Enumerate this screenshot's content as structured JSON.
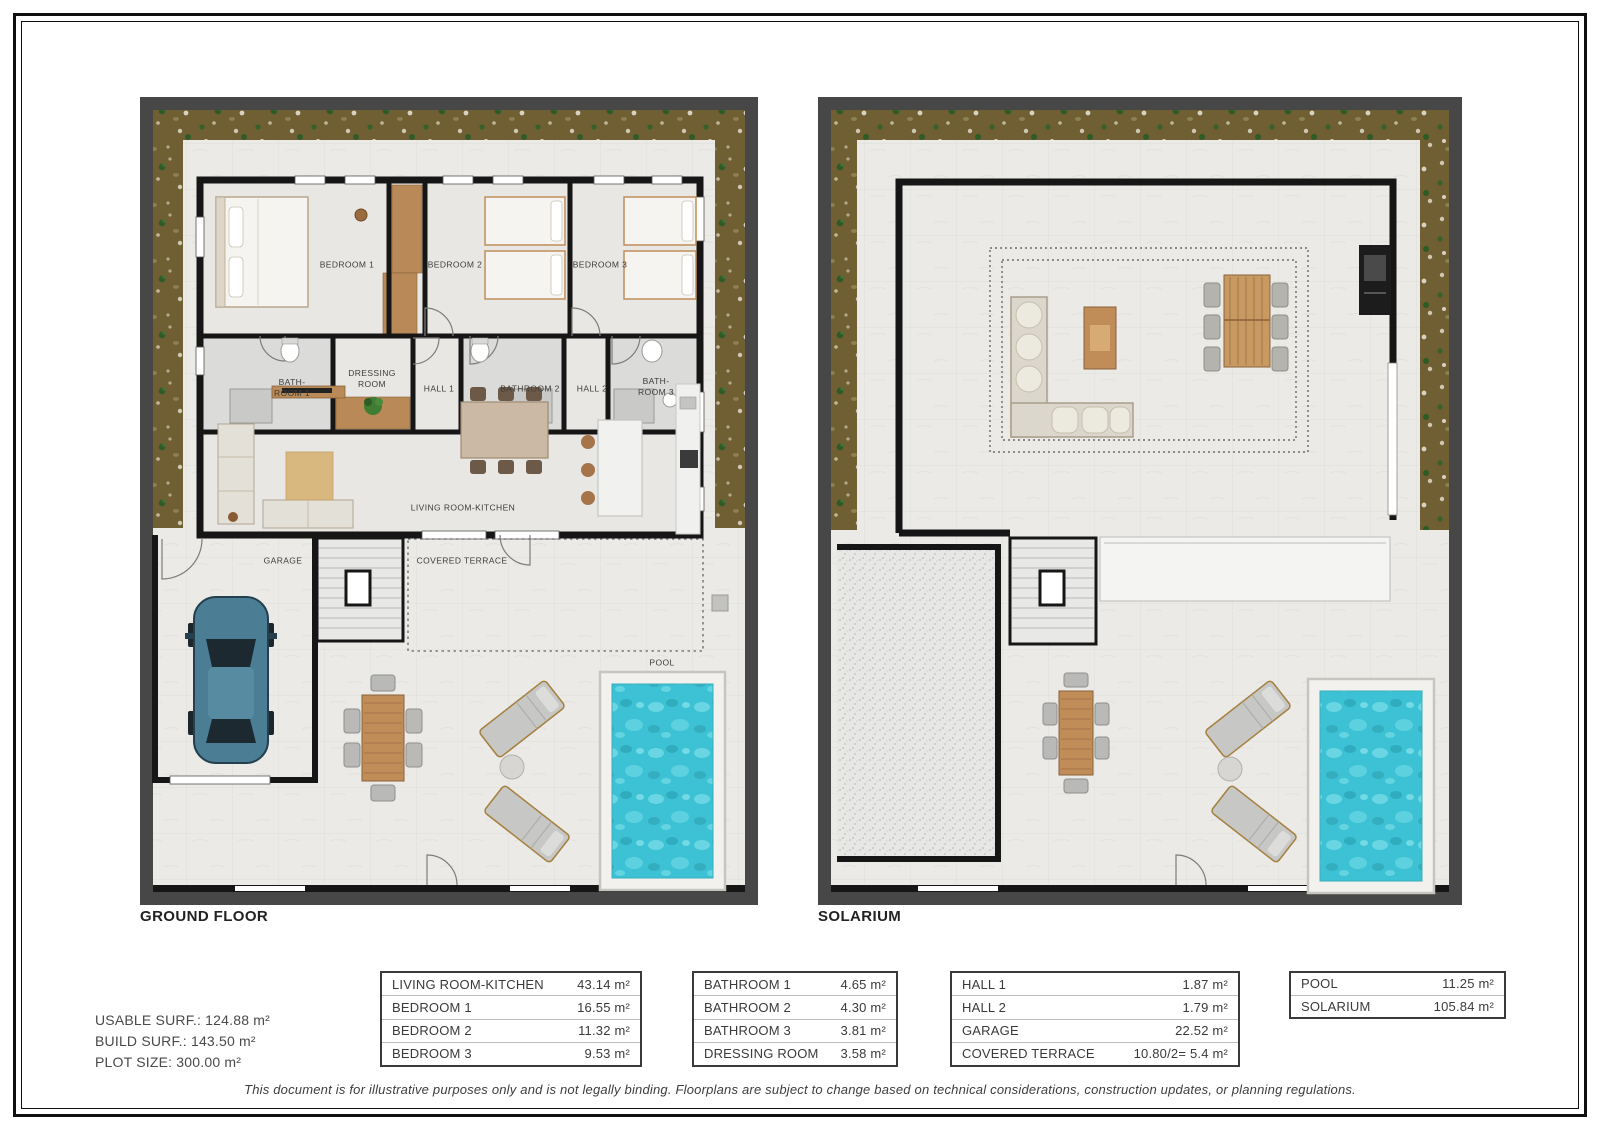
{
  "document": {
    "disclaimer": "This document is for illustrative purposes only and is not legally binding. Floorplans are subject to change based on technical considerations, construction updates, or planning regulations.",
    "stats": {
      "usable": "USABLE SURF.: 124.88 m²",
      "build": "BUILD SURF.: 143.50 m²",
      "plot": "PLOT SIZE: 300.00 m²"
    }
  },
  "plans": {
    "ground_floor": {
      "title": "GROUND FLOOR",
      "labels": {
        "bedroom1": "BEDROOM 1",
        "bedroom2": "BEDROOM 2",
        "bedroom3": "BEDROOM 3",
        "bathroom1": "BATH-\nROOM 1",
        "dressing_room": "DRESSING\nROOM",
        "hall1": "HALL 1",
        "bathroom2": "BATHROOM 2",
        "hall2": "HALL 2",
        "bathroom3": "BATH-\nROOM 3",
        "living_kitchen": "LIVING ROOM-KITCHEN",
        "garage": "GARAGE",
        "covered_terrace": "COVERED TERRACE",
        "pool": "POOL"
      }
    },
    "solarium": {
      "title": "SOLARIUM"
    }
  },
  "area_tables": [
    {
      "rows": [
        {
          "label": "LIVING ROOM-KITCHEN",
          "value": "43.14 m²"
        },
        {
          "label": "BEDROOM 1",
          "value": "16.55 m²"
        },
        {
          "label": "BEDROOM 2",
          "value": "11.32 m²"
        },
        {
          "label": "BEDROOM 3",
          "value": "9.53 m²"
        }
      ]
    },
    {
      "rows": [
        {
          "label": "BATHROOM 1",
          "value": "4.65 m²"
        },
        {
          "label": "BATHROOM 2",
          "value": "4.30 m²"
        },
        {
          "label": "BATHROOM 3",
          "value": "3.81 m²"
        },
        {
          "label": "DRESSING ROOM",
          "value": "3.58 m²"
        }
      ]
    },
    {
      "rows": [
        {
          "label": "HALL 1",
          "value": "1.87 m²"
        },
        {
          "label": "HALL 2",
          "value": "1.79 m²"
        },
        {
          "label": "GARAGE",
          "value": "22.52 m²"
        },
        {
          "label": "COVERED TERRACE",
          "value": "10.80/2= 5.4 m²"
        }
      ]
    },
    {
      "rows": [
        {
          "label": "POOL",
          "value": "11.25 m²"
        },
        {
          "label": "SOLARIUM",
          "value": "105.84 m²"
        }
      ]
    }
  ],
  "colors": {
    "wall": "#161616",
    "plan_frame": "#474747",
    "garden": "#6f5f33",
    "pool_water": "#3cc2d4",
    "wood": "#c08d58",
    "car_body": "#4b7e95"
  }
}
